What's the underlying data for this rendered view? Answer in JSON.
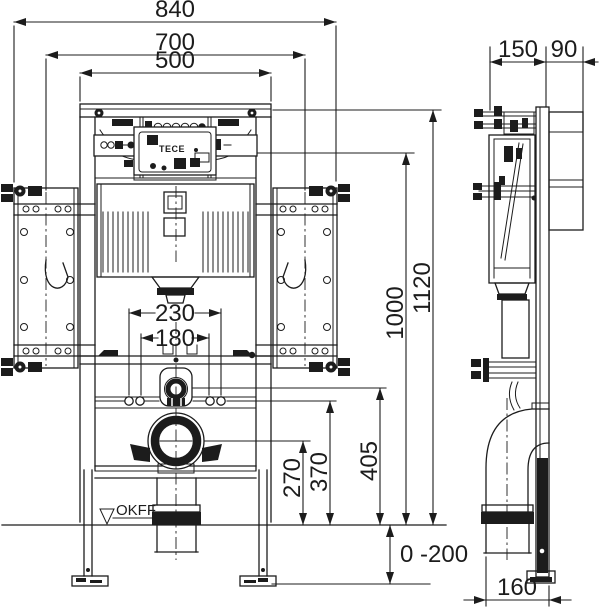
{
  "front": {
    "width_overall": "840",
    "width_brackets": "700",
    "width_frame": "500",
    "width_rods_outer": "230",
    "width_rods_inner": "180",
    "height_overall": "1120",
    "height_upper": "1000",
    "height_flush_pipe": "405",
    "height_rods": "370",
    "height_drain": "270",
    "foot_adjust": "0 -200",
    "floor_label": "OKFF",
    "unit_label": "TECE"
  },
  "side": {
    "depth_frame": "150",
    "depth_bracket": "90",
    "drain_offset": "160"
  },
  "colors": {
    "ink": "#1c1c1c",
    "paper": "#ffffff"
  }
}
